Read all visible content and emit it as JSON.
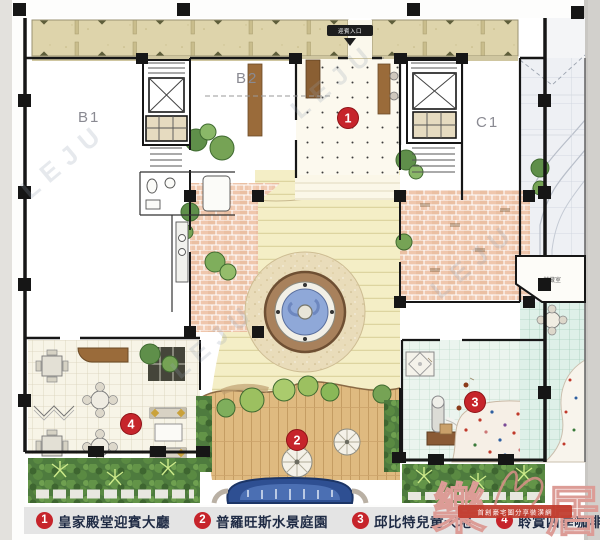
{
  "plan": {
    "units": {
      "b1": "B1",
      "b2": "B2",
      "c1": "C1"
    },
    "rooms": {
      "storage": "儲藏室"
    },
    "entrance_label": "迎賓入口"
  },
  "legend": {
    "items": [
      {
        "num": "1",
        "label": "皇家殿堂迎賓大廳"
      },
      {
        "num": "2",
        "label": "普羅旺斯水景庭園"
      },
      {
        "num": "3",
        "label": "邱比特兒童天地"
      },
      {
        "num": "4",
        "label": "聆賞四季咖啡小館"
      }
    ]
  },
  "watermark": {
    "repeat": "LEJU",
    "char_left": "樂",
    "char_right": "居",
    "banner": "首創豪宅圖分享裝潢網"
  },
  "colors": {
    "accent_red": "#c6242b",
    "wall_black": "#161616",
    "arcade_tan": "#ded4ab",
    "brick_pink": "#efc6ac",
    "path_yellow": "#f4eec6",
    "plaza_tan": "#e9dcba",
    "fountain_blue": "#8fa8d8",
    "pool_blue": "#2e4f92",
    "deck_wood": "#dfba80",
    "hedge_green": "#4e7b3e",
    "mint_tile": "#ebf4ee",
    "legend_text": "#1e2a44"
  }
}
